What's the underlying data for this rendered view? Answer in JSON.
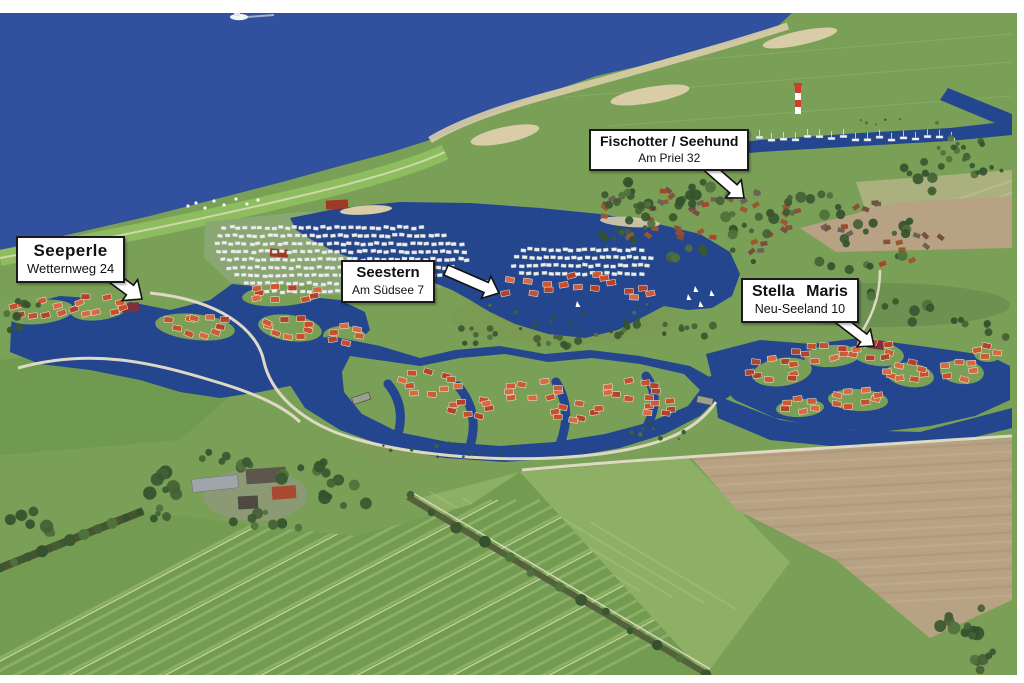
{
  "callouts": [
    {
      "id": "seeperle",
      "name": "Seeperle",
      "address": "Wetternweg 24"
    },
    {
      "id": "seestern",
      "name": "Seestern",
      "address": "Am Südsee 7"
    },
    {
      "id": "fischotter-seehund",
      "name": "Fischotter / Seehund",
      "address": "Am Priel 32"
    },
    {
      "id": "stella-maris",
      "name": "Stella Maris",
      "address": "Neu-Seeland 10"
    }
  ],
  "palette": {
    "sea": "#31509d",
    "lake": "#24468f",
    "grass": "#7aa057",
    "grass_dark": "#6f9a50",
    "grass_light": "#8db064",
    "dike_green": "#8ebd5f",
    "sand": "#d9cda8",
    "path": "#ddd9c3",
    "plowed_field": "#b7a284",
    "field_stripe": "#a6c77e",
    "roof_red": "#c7502c",
    "roof_red_light": "#d9693f",
    "roof_red_dark": "#b2432a",
    "roof_maroon": "#7e2f3e",
    "caravan_white": "#eceeec",
    "tree_green": "#3c5a32",
    "label_bg": "#ffffff",
    "label_border": "#1a1a1a",
    "label_text": "#111111",
    "arrow_fill": "#ffffff",
    "arrow_outline": "#111111"
  }
}
